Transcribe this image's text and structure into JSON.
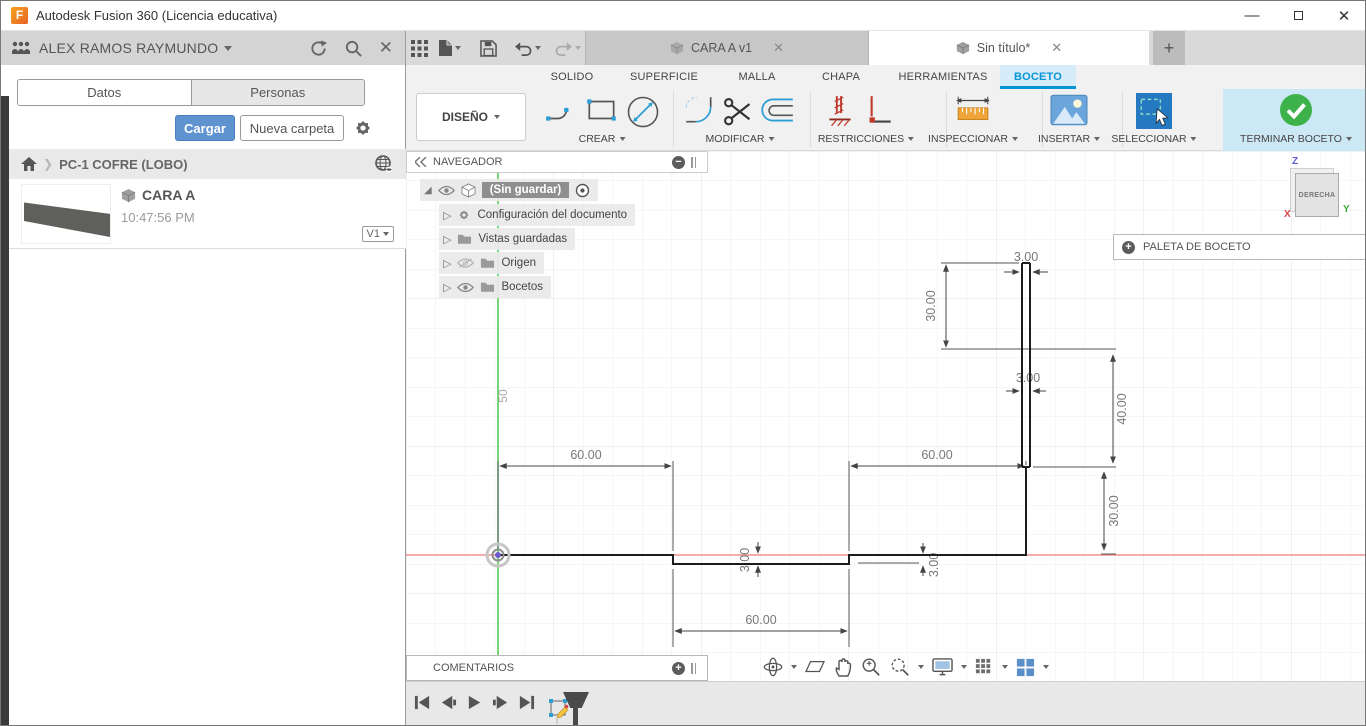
{
  "titlebar": {
    "title": "Autodesk Fusion 360 (Licencia educativa)"
  },
  "data_panel": {
    "user_name": "ALEX RAMOS RAYMUNDO",
    "tab_datos": "Datos",
    "tab_personas": "Personas",
    "upload": "Cargar",
    "new_folder": "Nueva carpeta",
    "breadcrumb": "PC-1 COFRE (LOBO)",
    "item_title": "CARA A",
    "item_time": "10:47:56 PM",
    "item_version": "V1"
  },
  "appbar": {
    "tab_inactive": "CARA A v1",
    "tab_active": "Sin título*",
    "avatar": "AR"
  },
  "ribbon": {
    "workspace": "DISEÑO",
    "tabs": [
      "SOLIDO",
      "SUPERFICIE",
      "MALLA",
      "CHAPA",
      "HERRAMIENTAS",
      "BOCETO"
    ],
    "active_tab": "BOCETO",
    "crear": "CREAR",
    "modificar": "MODIFICAR",
    "restricciones": "RESTRICCIONES",
    "inspeccionar": "INSPECCIONAR",
    "insertar": "INSERTAR",
    "seleccionar": "SELECCIONAR",
    "terminar": "TERMINAR BOCETO"
  },
  "navegador": {
    "title": "NAVEGADOR",
    "root": "(Sin guardar)",
    "items": [
      "Configuración del documento",
      "Vistas guardadas",
      "Origen",
      "Bocetos"
    ]
  },
  "canvas": {
    "axis_scale_label": "50",
    "dims": [
      "30.00",
      "3.00",
      "3.00",
      "40.00",
      "60.00",
      "60.00",
      "30.00",
      "60.00",
      "3.00",
      "3.00"
    ]
  },
  "viewcube": {
    "face": "DERECHA",
    "z": "Z",
    "x": "X",
    "y": "Y"
  },
  "paleta_title": "PALETA DE BOCETO",
  "comentarios_title": "COMENTARIOS",
  "colors": {
    "accent_blue": "#0696d7",
    "button_blue": "#5e93cf",
    "check_green": "#3db24a",
    "axis_red": "#ef8f8f",
    "axis_green": "#4cc94c",
    "select_blue": "#2479c1",
    "constraint_red": "#c0392b",
    "ruler_orange": "#f0a43c"
  }
}
